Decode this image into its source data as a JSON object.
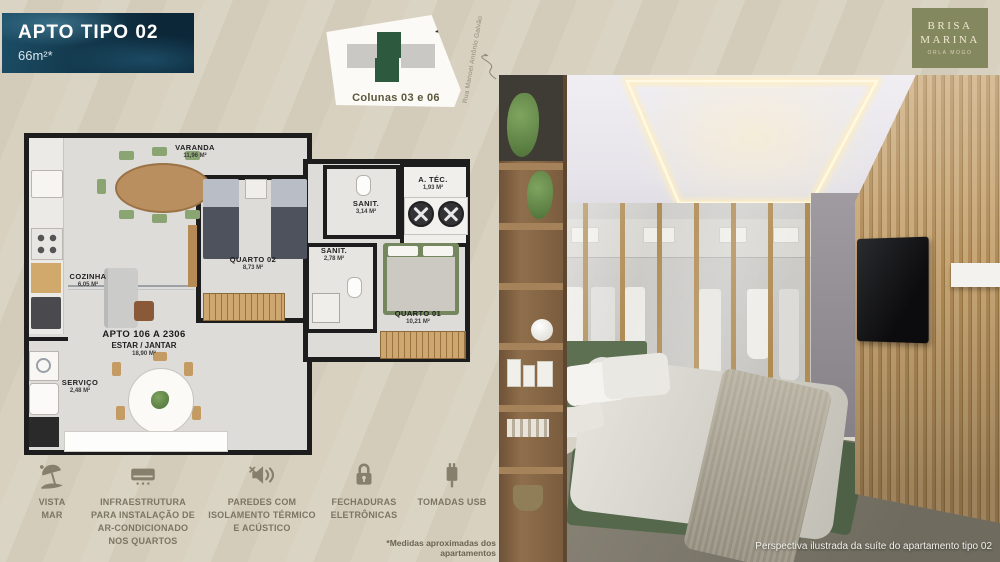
{
  "header": {
    "title": "APTO TIPO 02",
    "subtitle": "66m²*"
  },
  "site_plan": {
    "caption": "Colunas 03 e 06",
    "street_label": "Rua Manoel Antônio Galvão"
  },
  "floor_plan": {
    "unit_label": "APTO 106 A 2306",
    "rooms": [
      {
        "name": "VARANDA",
        "area": "11,96 M²"
      },
      {
        "name": "COZINHA",
        "area": "6,05 M²"
      },
      {
        "name": "QUARTO 02",
        "area": "8,73 M²"
      },
      {
        "name": "SANIT.",
        "area": "3,14 M²"
      },
      {
        "name": "SANIT.",
        "area": "2,78 M²"
      },
      {
        "name": "A. TÉC.",
        "area": "1,93 M²"
      },
      {
        "name": "QUARTO 01",
        "area": "10,21 M²"
      },
      {
        "name": "ESTAR / JANTAR",
        "area": "18,90 M²"
      },
      {
        "name": "SERVIÇO",
        "area": "2,48 M²"
      }
    ]
  },
  "amenities": [
    {
      "icon": "beach-umbrella-icon",
      "label": "VISTA\nMAR"
    },
    {
      "icon": "air-conditioner-icon",
      "label": "INFRAESTRUTURA\nPARA INSTALAÇÃO DE\nAR-CONDICIONADO\nNOS QUARTOS"
    },
    {
      "icon": "acoustic-insulation-icon",
      "label": "PAREDES COM\nISOLAMENTO TÉRMICO\nE ACÚSTICO"
    },
    {
      "icon": "electronic-lock-icon",
      "label": "FECHADURAS\nELETRÔNICAS"
    },
    {
      "icon": "usb-outlet-icon",
      "label": "TOMADAS USB"
    }
  ],
  "footnote": "*Medidas aproximadas dos apartamentos",
  "photo": {
    "caption": "Perspectiva ilustrada da suíte do apartamento tipo 02"
  },
  "logo": {
    "name": "BRISA\nMARINA",
    "tagline": "ORLA MOGO"
  },
  "colors": {
    "banner_blue": "#14455c",
    "site_green": "#2d5a3e",
    "text_olive": "#5c573c",
    "icon_olive": "#857f6b",
    "logo_olive": "#84885e",
    "bed_green": "#5d7052",
    "wall_black": "#1d1d1d"
  }
}
